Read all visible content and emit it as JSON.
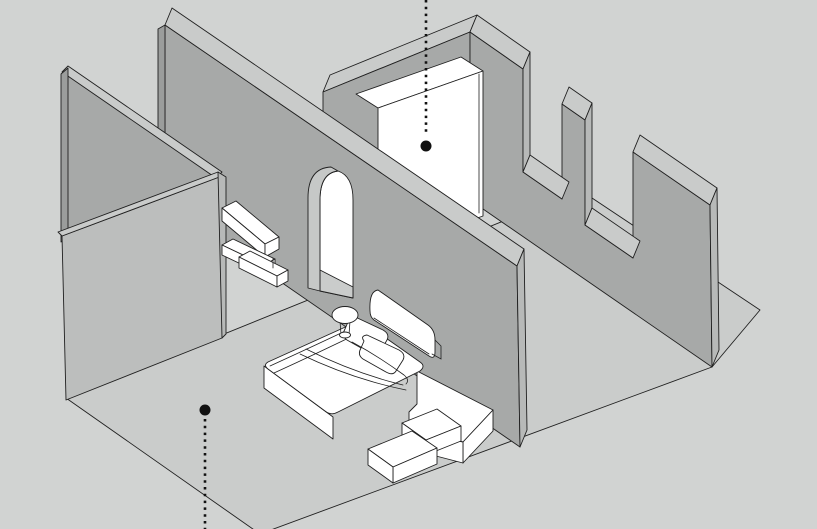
{
  "scene": {
    "type": "isometric-architectural-illustration",
    "subject": "bedroom cutaway with annotation markers"
  },
  "colors": {
    "background": "#d1d3d2",
    "floor": "#cacccb",
    "wall_face": "#a7a9a8",
    "wall_face_light": "#bcbebd",
    "wall_top": "#c9cbca",
    "wall_cap": "#b7b9b8",
    "wall_cap_dark": "#9b9d9c",
    "arch_reveal": "#c6c8c7",
    "object_white": "#ffffff",
    "outline": "#202020",
    "marker": "#111111"
  },
  "annotations": {
    "marker_top": {
      "x": 426,
      "line_y1": 0,
      "line_y2": 136,
      "dot_y": 146,
      "dot_r": 5.5,
      "target": "wardrobe"
    },
    "marker_bottom": {
      "x": 205,
      "line_y1": 419,
      "line_y2": 529,
      "dot_y": 410,
      "dot_r": 5.5,
      "target": "floor"
    }
  },
  "objects": {
    "walls": [
      "back-left-wall",
      "front-left-wall",
      "arch-wall",
      "back-wall",
      "crenellated-wall"
    ],
    "openings": [
      "arched-doorway"
    ],
    "furniture": [
      "wardrobe",
      "wall-shelves",
      "bed",
      "side-table",
      "platform",
      "steps"
    ]
  }
}
